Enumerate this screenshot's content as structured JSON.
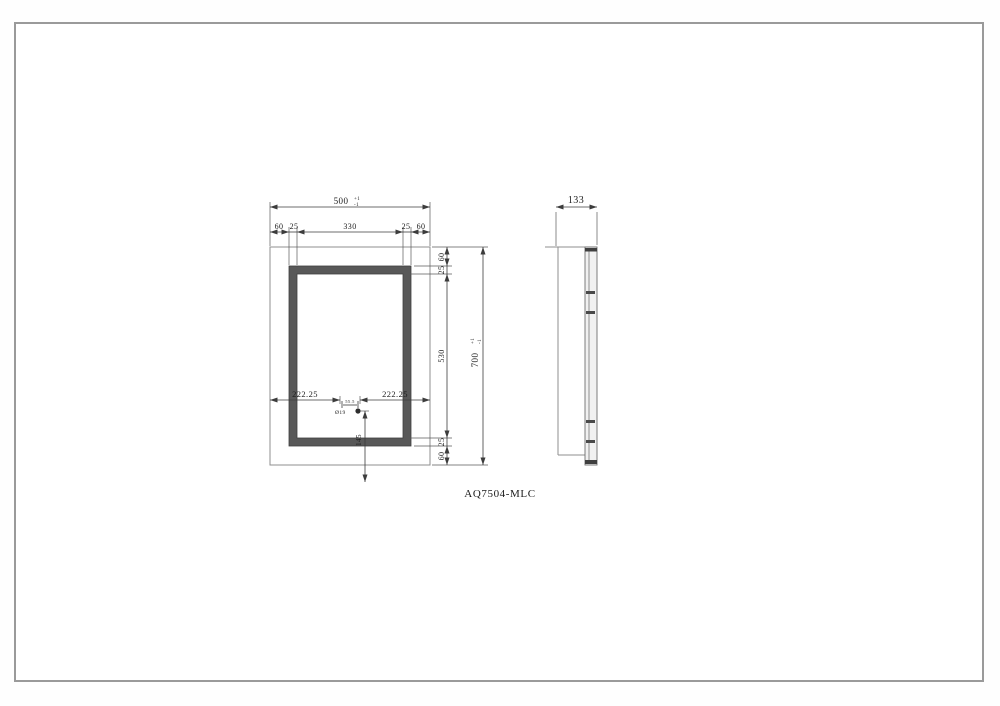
{
  "drawing": {
    "part_number": "AQ7504-MLC",
    "front": {
      "overall_width": "500",
      "overall_width_tol_plus": "+1",
      "overall_width_tol_minus": "-1",
      "top_chain": [
        "60",
        "25",
        "330",
        "25",
        "60"
      ],
      "right_chain": [
        "60",
        "25",
        "530",
        "25",
        "60"
      ],
      "overall_height": "700",
      "overall_height_tol_plus": "+1",
      "overall_height_tol_minus": "-1",
      "left_to_sensor": "222.25",
      "right_to_sensor": "222.25",
      "sensor_group_width": "55.5",
      "sensor_diameter": "Ø19",
      "sensor_from_bottom": "145"
    },
    "side": {
      "depth": "133"
    }
  }
}
